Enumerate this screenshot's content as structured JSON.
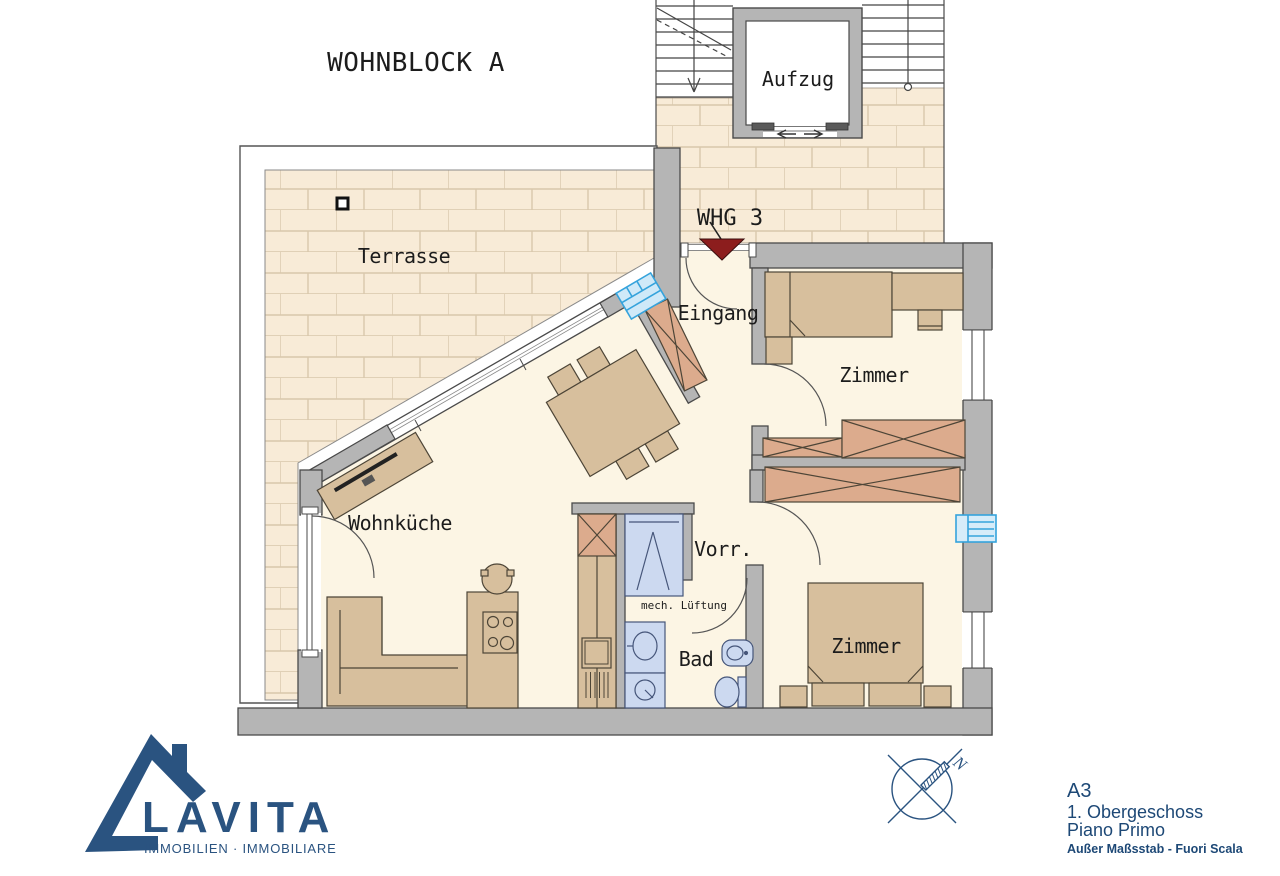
{
  "plan": {
    "building_title": "WOHNBLOCK A",
    "elevator_label": "Aufzug",
    "apartment_label": "WHG 3",
    "entrance_label": "Eingang",
    "terrace_label": "Terrasse",
    "room_top_label": "Zimmer",
    "room_bottom_label": "Zimmer",
    "living_kitchen_label": "Wohnküche",
    "hall_label": "Vorr.",
    "vent_label": "mech. Lüftung",
    "bath_label": "Bad"
  },
  "footer": {
    "brand": "LAVITA",
    "brand_subtitle": "IMMOBILIEN · IMMOBILIARE",
    "north_label": "N",
    "sheet": "A3",
    "floor_de": "1. Obergeschoss",
    "floor_it": "Piano Primo",
    "scale_note": "Außer Maßsstab - Fuori Scala"
  },
  "colors": {
    "wall_gray": "#b5b5b5",
    "brick_fill": "#f8ebd7",
    "brick_joint": "#d9c7ac",
    "floor_cream": "#fcf5e4",
    "furniture_tan": "#d7bf9d",
    "wardrobe_salmon": "#dcab8d",
    "sanitary_blue": "#ccd9f0",
    "radiator_blue": "#cfe9f8",
    "radiator_stroke": "#35a3dc",
    "entry_arrow_red": "#8c1d1d",
    "brand_blue": "#2a5380",
    "sheet_text_blue": "#1d4876"
  }
}
